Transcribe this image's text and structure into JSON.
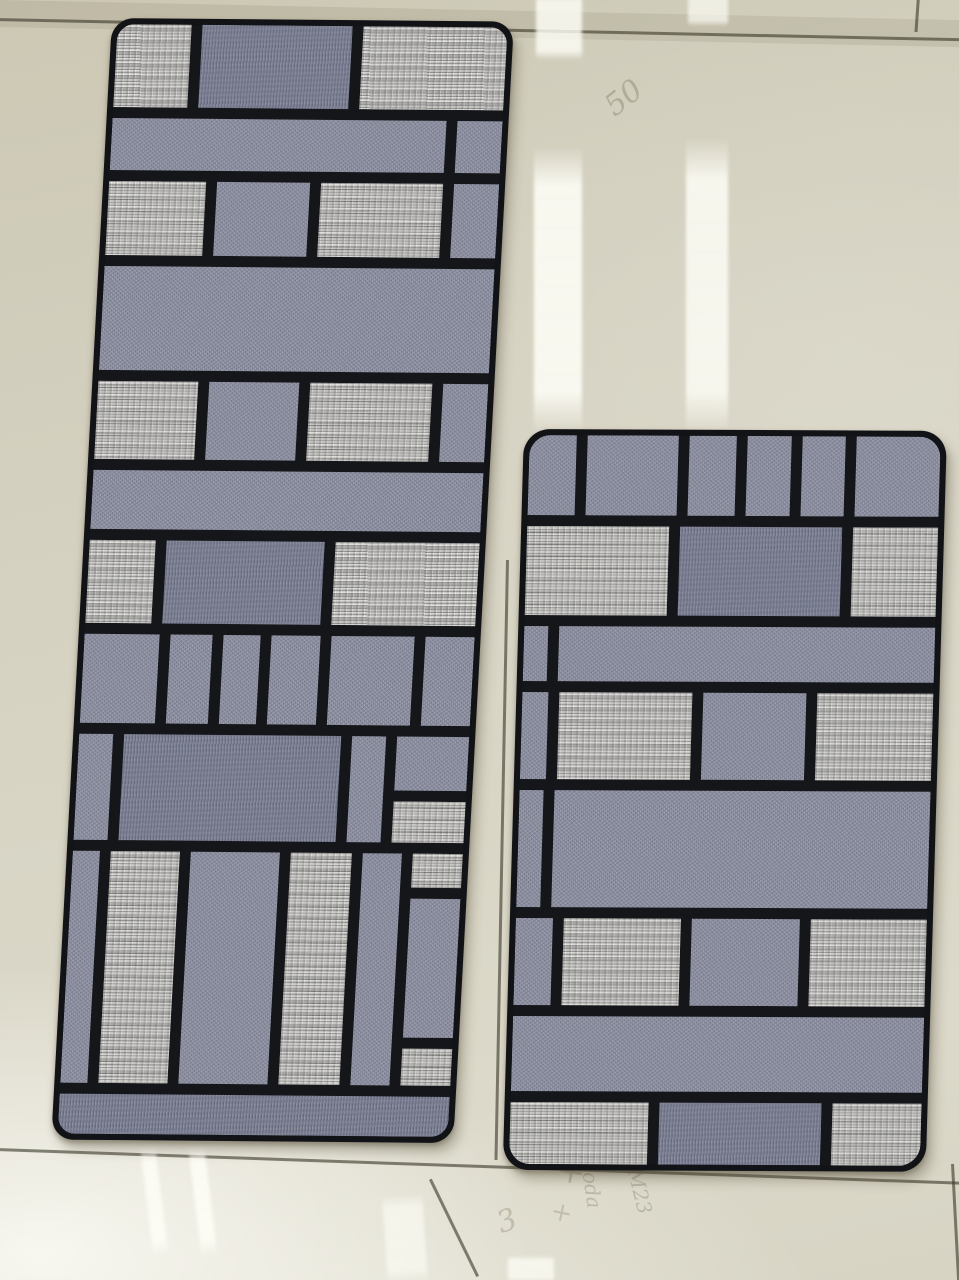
{
  "scene": {
    "caption": "Two grey Mondrian-pattern fabric kitchen mats lying on a glossy beige tile showroom floor",
    "palette": {
      "mat_line": "#15161a",
      "mat_edge": "#121317",
      "fabric_light": "#c6c5c0",
      "fabric_medium": "#8b8ea0",
      "fabric_dark": "#777b8f",
      "floor_base": "#d5d1c0",
      "floor_sheen": "#fbfaef",
      "grout": "#4a4636",
      "line_px": 11
    },
    "floor": {
      "grout_lines": [
        {
          "x": -4,
          "y": 18,
          "len": 975,
          "rot": 1.2,
          "o": "h"
        },
        {
          "x": 917,
          "y": -4,
          "len": 36,
          "rot": 4,
          "o": "v"
        },
        {
          "x": -4,
          "y": 1148,
          "len": 975,
          "rot": 2.0,
          "o": "h"
        },
        {
          "x": 506,
          "y": 560,
          "len": 600,
          "rot": 1.1,
          "o": "v"
        },
        {
          "x": 429,
          "y": 1180,
          "len": 108,
          "rot": -26,
          "o": "v"
        },
        {
          "x": 951,
          "y": 1164,
          "len": 120,
          "rot": -3,
          "o": "v"
        }
      ],
      "reflections": [
        {
          "x": 536,
          "y": -8,
          "w": 46,
          "h": 68,
          "rot": 0,
          "op": 0.85
        },
        {
          "x": 688,
          "y": -8,
          "w": 40,
          "h": 34,
          "rot": 0,
          "op": 0.7
        },
        {
          "x": 534,
          "y": 146,
          "w": 48,
          "h": 287,
          "rot": 0,
          "op": 0.9
        },
        {
          "x": 686,
          "y": 138,
          "w": 42,
          "h": 295,
          "rot": 0,
          "op": 0.85
        },
        {
          "x": 140,
          "y": 1146,
          "w": 15,
          "h": 112,
          "rot": -7,
          "op": 0.8
        },
        {
          "x": 188,
          "y": 1146,
          "w": 16,
          "h": 112,
          "rot": -7,
          "op": 0.85
        },
        {
          "x": 382,
          "y": 1196,
          "w": 40,
          "h": 88,
          "rot": -4,
          "op": 0.6
        },
        {
          "x": 508,
          "y": 1256,
          "w": 46,
          "h": 26,
          "rot": 0,
          "op": 0.75
        }
      ],
      "markings": [
        {
          "text": "50",
          "x": 598,
          "y": 96,
          "size": 30,
          "rot": -38,
          "op": 0.33
        },
        {
          "text": "+",
          "x": 560,
          "y": 1150,
          "size": 34,
          "rot": 8,
          "op": 0.3
        },
        {
          "text": "+",
          "x": 554,
          "y": 1196,
          "size": 26,
          "rot": 12,
          "op": 0.25
        },
        {
          "text": "3",
          "x": 492,
          "y": 1208,
          "size": 30,
          "rot": -20,
          "op": 0.28
        },
        {
          "text": "soda",
          "x": 600,
          "y": 1160,
          "size": 20,
          "rot": 82,
          "op": 0.3
        },
        {
          "text": "M23",
          "x": 646,
          "y": 1166,
          "size": 20,
          "rot": 76,
          "op": 0.3
        }
      ]
    },
    "mats": [
      {
        "id": "left-mat",
        "x": 112,
        "y": 18,
        "w": 402,
        "h": 1122,
        "rot": 0.5,
        "skew": -2.6,
        "radius": 22,
        "rows": [
          {
            "h": 84,
            "cells": [
              {
                "t": "light",
                "w": 20
              },
              {
                "t": "dark",
                "w": 41
              },
              {
                "t": "light",
                "w": 39
              }
            ]
          },
          {
            "h": 53,
            "cells": [
              {
                "t": "medium",
                "w": 88
              },
              {
                "t": "medium",
                "w": 12
              }
            ]
          },
          {
            "h": 75,
            "cells": [
              {
                "t": "light",
                "w": 26
              },
              {
                "t": "medium",
                "w": 25
              },
              {
                "t": "light",
                "w": 33
              },
              {
                "t": "medium",
                "w": 12
              }
            ]
          },
          {
            "h": 105,
            "cells": [
              {
                "t": "medium",
                "w": 100
              }
            ]
          },
          {
            "h": 79,
            "cells": [
              {
                "t": "light",
                "w": 27
              },
              {
                "t": "medium",
                "w": 24
              },
              {
                "t": "light",
                "w": 33
              },
              {
                "t": "medium",
                "w": 12
              }
            ]
          },
          {
            "h": 59,
            "cells": [
              {
                "t": "medium",
                "w": 100
              }
            ]
          },
          {
            "h": 84,
            "cells": [
              {
                "t": "light",
                "w": 18
              },
              {
                "t": "dark",
                "w": 43
              },
              {
                "t": "light",
                "w": 39
              }
            ]
          },
          {
            "h": 90,
            "cells": [
              {
                "t": "medium",
                "w": 20
              },
              {
                "t": "medium",
                "w": 11
              },
              {
                "t": "medium",
                "w": 10
              },
              {
                "t": "medium",
                "w": 13
              },
              {
                "t": "medium",
                "w": 22
              },
              {
                "t": "medium",
                "w": 13
              }
            ]
          },
          {
            "h": 108,
            "cells": [
              {
                "t": "medium",
                "w": 9
              },
              {
                "t": "dark",
                "w": 57
              },
              {
                "t": "medium",
                "w": 9
              },
              {
                "t": "stack",
                "w": 19,
                "cells": [
                  {
                    "t": "medium",
                    "h": 55
                  },
                  {
                    "t": "light",
                    "h": 42
                  }
                ]
              }
            ]
          },
          {
            "h": 235,
            "cells": [
              {
                "t": "medium",
                "w": 7
              },
              {
                "t": "light",
                "w": 18
              },
              {
                "t": "medium",
                "w": 23
              },
              {
                "t": "light",
                "w": 16
              },
              {
                "t": "medium",
                "w": 10
              },
              {
                "t": "stack",
                "w": 13,
                "cells": [
                  {
                    "t": "light",
                    "h": 33
                  },
                  {
                    "t": "medium",
                    "h": 135
                  },
                  {
                    "t": "light",
                    "h": 36
                  }
                ]
              }
            ]
          },
          {
            "h": 40,
            "cells": [
              {
                "t": "dark",
                "w": 100
              }
            ]
          }
        ]
      },
      {
        "id": "right-mat",
        "x": 524,
        "y": 429,
        "w": 423,
        "h": 741,
        "rot": 0.25,
        "skew": -1.4,
        "radius": 26,
        "rows": [
          {
            "h": 80,
            "cells": [
              {
                "t": "medium",
                "w": 13
              },
              {
                "t": "medium",
                "w": 25
              },
              {
                "t": "medium",
                "w": 13
              },
              {
                "t": "medium",
                "w": 12
              },
              {
                "t": "medium",
                "w": 12
              },
              {
                "t": "medium",
                "w": 23
              }
            ]
          },
          {
            "h": 89,
            "cells": [
              {
                "t": "light",
                "w": 35
              },
              {
                "t": "dark",
                "w": 40
              },
              {
                "t": "light",
                "w": 21
              }
            ]
          },
          {
            "h": 55,
            "cells": [
              {
                "t": "medium",
                "w": 6
              },
              {
                "t": "medium",
                "w": 94
              }
            ]
          },
          {
            "h": 87,
            "cells": [
              {
                "t": "medium",
                "w": 6
              },
              {
                "t": "light",
                "w": 31
              },
              {
                "t": "medium",
                "w": 24
              },
              {
                "t": "light",
                "w": 27
              }
            ]
          },
          {
            "h": 116,
            "cells": [
              {
                "t": "medium",
                "w": 6
              },
              {
                "t": "medium",
                "w": 94
              }
            ]
          },
          {
            "h": 87,
            "cells": [
              {
                "t": "medium",
                "w": 9
              },
              {
                "t": "light",
                "w": 28
              },
              {
                "t": "medium",
                "w": 26
              },
              {
                "t": "light",
                "w": 28
              }
            ]
          },
          {
            "h": 75,
            "cells": [
              {
                "t": "medium",
                "w": 100
              }
            ]
          },
          {
            "h": 62,
            "cells": [
              {
                "t": "light",
                "w": 34
              },
              {
                "t": "dark",
                "w": 40
              },
              {
                "t": "light",
                "w": 22
              }
            ]
          }
        ]
      }
    ]
  }
}
